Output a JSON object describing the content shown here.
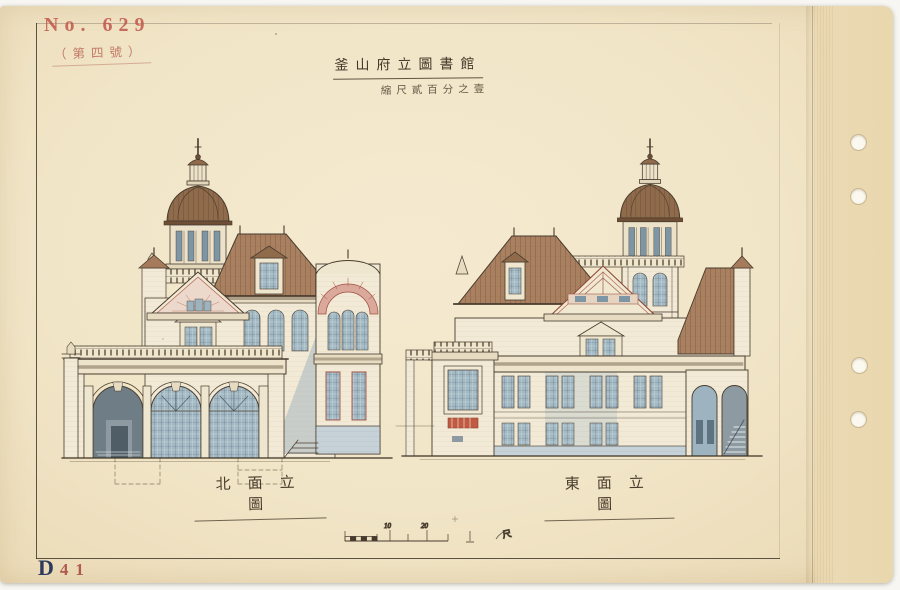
{
  "archive": {
    "number_stamp": "No. 629",
    "annotation": "（第四號）",
    "plate_letter": "D",
    "plate_number": "41"
  },
  "title_block": {
    "title": "釜山府立圖書館",
    "scale_note": "縮尺貳百分之壹"
  },
  "elevations": [
    {
      "name": "north-elevation",
      "caption": "北面立圖"
    },
    {
      "name": "east-elevation",
      "caption": "東面立圖"
    }
  ],
  "scale_bar": {
    "tick_labels": [
      "10",
      "20"
    ],
    "unit_label": "尺"
  },
  "colors": {
    "paper": "#f1e5c7",
    "binding_strip": "#ead9b2",
    "ink": "#47392c",
    "roof_brown": "#a87e5e",
    "dome_brown": "#8f6b4c",
    "wall_cream": "#f2ead6",
    "window_glass": "#a3b9c4",
    "shadow_blue": "#a9bcc6",
    "accent_red": "#b5685a",
    "stamp_red": "#bf5146",
    "plate_navy": "#2c3a5c"
  }
}
